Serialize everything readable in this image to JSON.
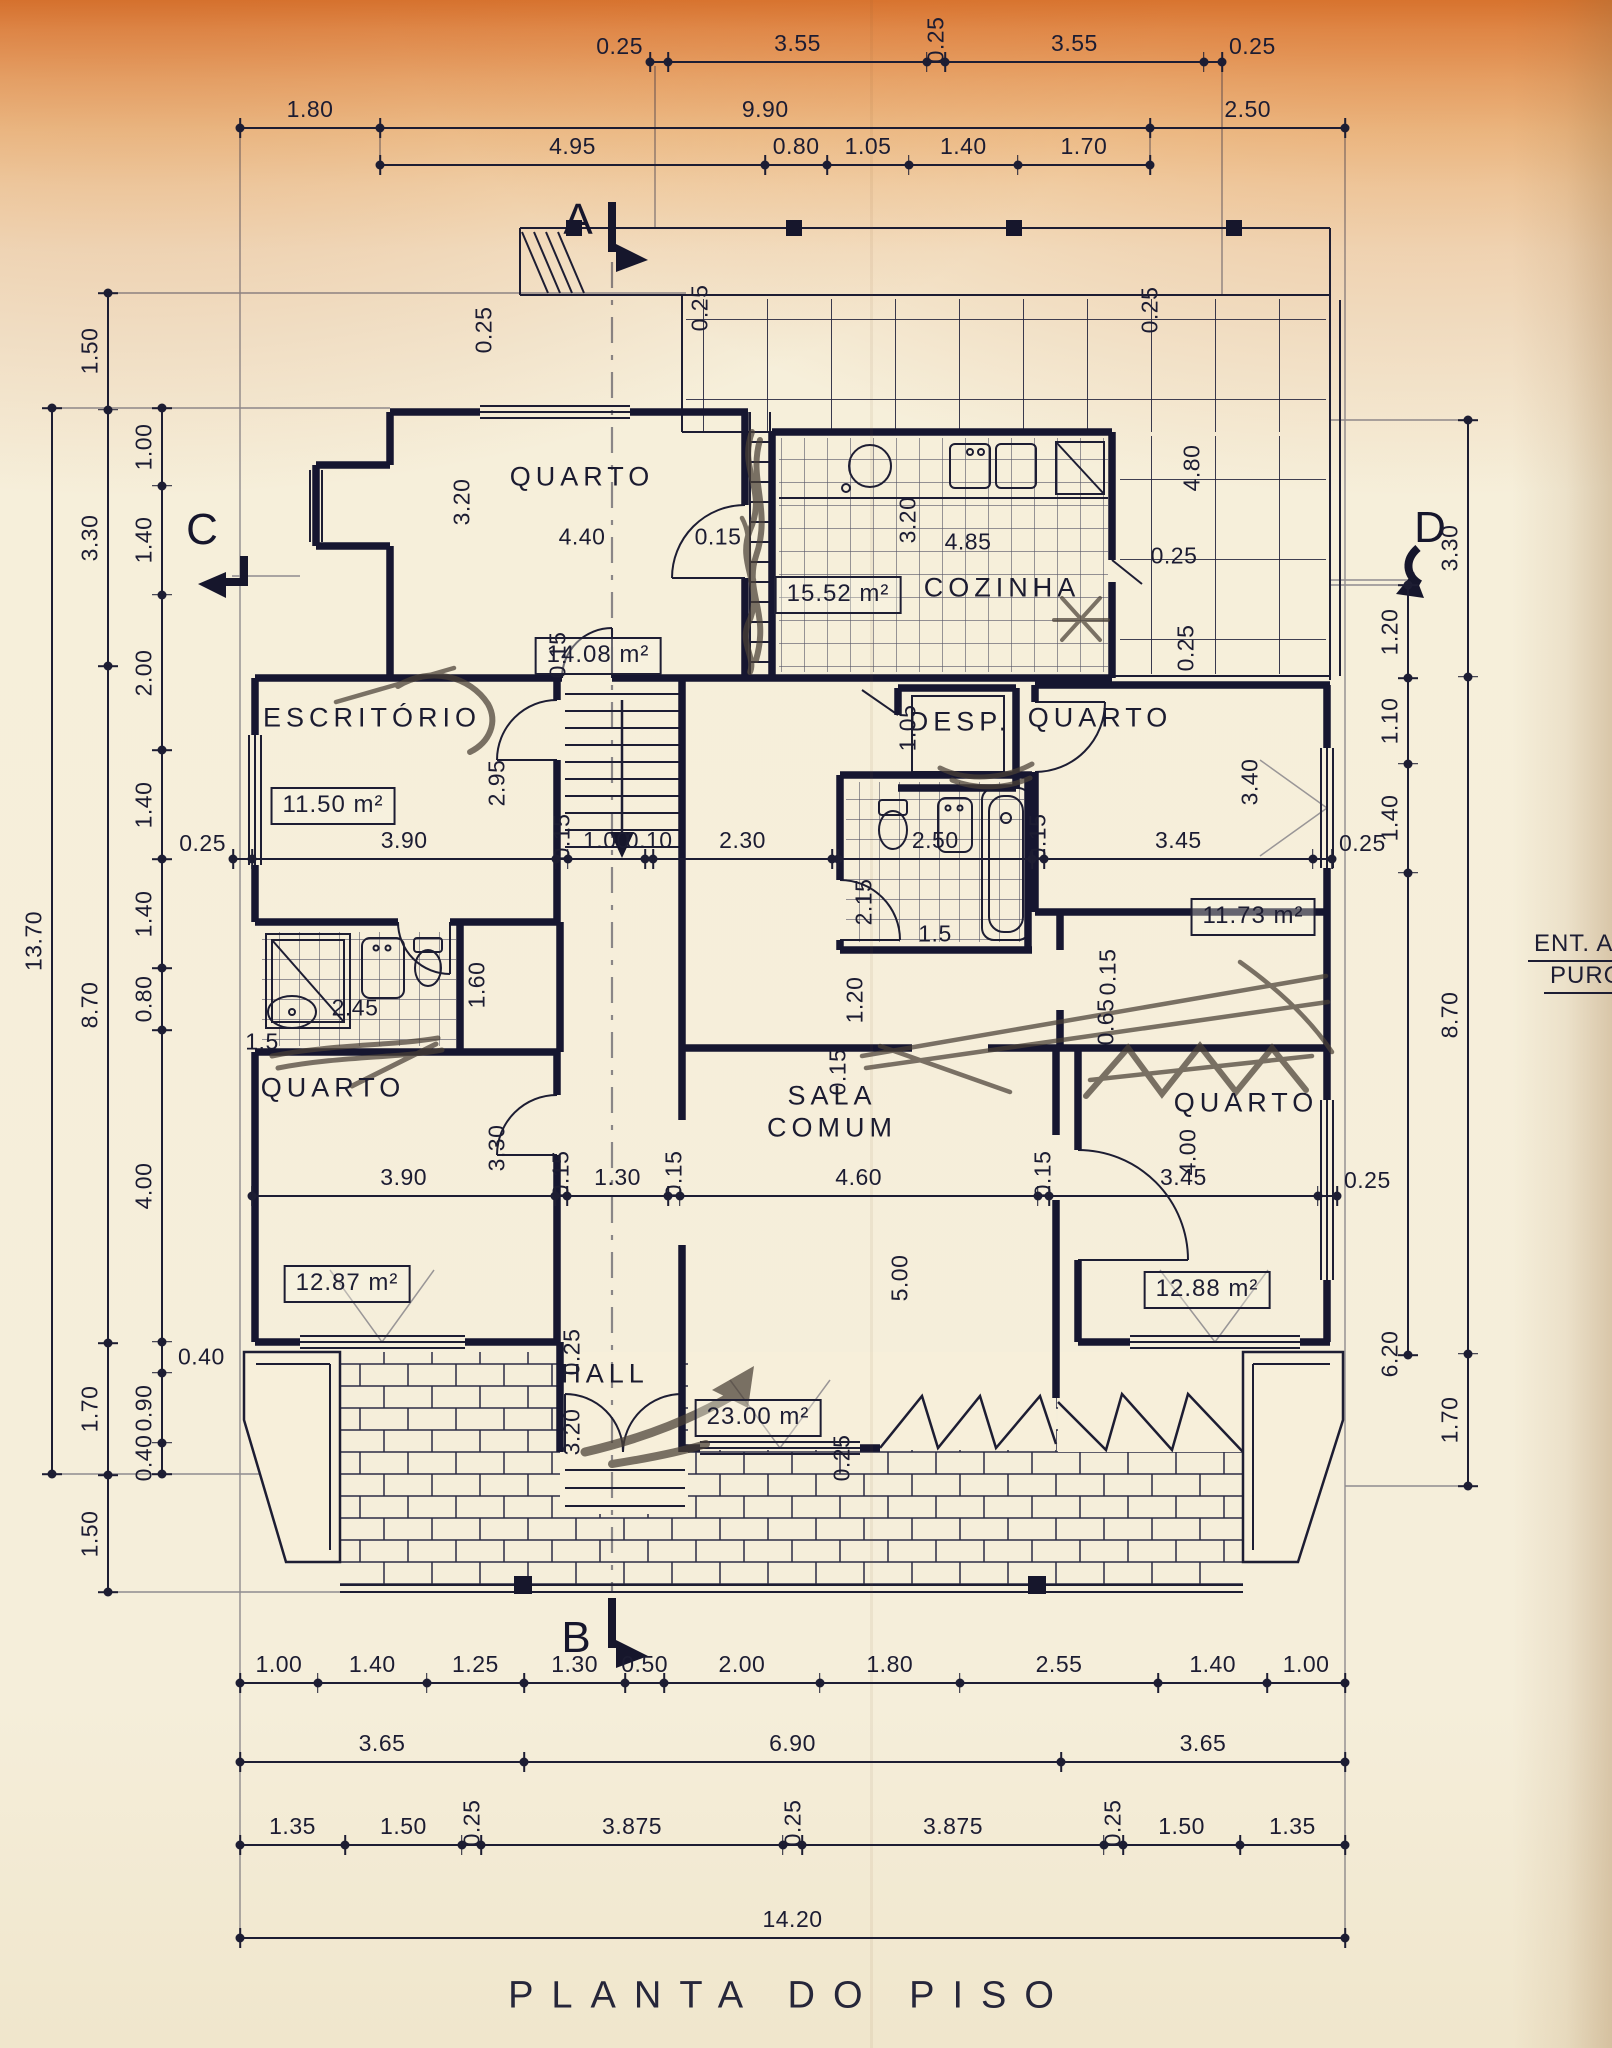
{
  "title": "PLANTA DO PISO",
  "side_note": [
    "ENT. A",
    "PURC"
  ],
  "section_markers": [
    "A",
    "B",
    "C",
    "D"
  ],
  "rooms": [
    {
      "id": "quarto-1",
      "label": "QUARTO",
      "area": "14.08 m²"
    },
    {
      "id": "cozinha",
      "label": "COZINHA",
      "area": "15.52 m²"
    },
    {
      "id": "escritorio",
      "label": "ESCRITÓRIO",
      "area": "11.50 m²"
    },
    {
      "id": "despensa",
      "label": "DESP."
    },
    {
      "id": "quarto-2",
      "label": "QUARTO",
      "area": "11.73 m²"
    },
    {
      "id": "quarto-3",
      "label": "QUARTO",
      "area": "12.87 m²"
    },
    {
      "id": "sala-comum",
      "label": "SALA COMUM",
      "area": "23.00 m²"
    },
    {
      "id": "hall",
      "label": "HALL"
    },
    {
      "id": "quarto-4",
      "label": "QUARTO",
      "area": "12.88 m²"
    }
  ],
  "dim_chains": {
    "t1": [
      "0.25",
      "3.55",
      "0.25",
      "3.55",
      "0.25"
    ],
    "t2": [
      "1.80",
      "9.90",
      "2.50"
    ],
    "t3": [
      "4.95",
      "0.80",
      "1.05",
      "1.40",
      "1.70"
    ],
    "m1a": [
      "0.25",
      "3.90",
      "0.15",
      "1.00",
      "0.10",
      "2.30"
    ],
    "m1b": [
      "2.50",
      "0.15",
      "3.45",
      "0.25"
    ],
    "m2": [
      "3.90",
      "0.15",
      "1.30",
      "0.15",
      "4.60",
      "0.15",
      "3.45",
      "0.25"
    ],
    "b1": [
      "1.00",
      "1.40",
      "1.25",
      "1.30",
      "0.50",
      "2.00",
      "1.80",
      "2.55",
      "1.40",
      "1.00"
    ],
    "b2": [
      "3.65",
      "6.90",
      "3.65"
    ],
    "b3": [
      "1.35",
      "1.50",
      "0.25",
      "3.875",
      "0.25",
      "3.875",
      "0.25",
      "1.50",
      "1.35"
    ],
    "b4": [
      "14.20"
    ],
    "l1": [
      "13.70"
    ],
    "l2": [
      "1.50",
      "3.30",
      "8.70",
      "1.70",
      "1.50"
    ],
    "l3": [
      "1.00",
      "1.40",
      "2.00",
      "1.40",
      "1.40",
      "0.80",
      "4.00",
      "0.40",
      "0.90",
      "0.40"
    ],
    "r1": [
      "3.30",
      "8.70",
      "1.70"
    ],
    "r2": [
      "1.20",
      "1.10",
      "1.40",
      "6.20"
    ]
  },
  "free_dims": [
    "0.25",
    "0.25",
    "0.25",
    "3.20",
    "4.40",
    "0.15",
    "3.20",
    "4.85",
    "4.80",
    "0.25",
    "0.25",
    "0.15",
    "2.95",
    "1.05",
    "2.15",
    "1.5",
    "2.45",
    "1.5",
    "1.60",
    "1.20",
    "3.30",
    "0.15",
    "0.15",
    "0.65",
    "4.00",
    "5.00",
    "3.40",
    "0.25",
    "3.20",
    "0.25"
  ]
}
